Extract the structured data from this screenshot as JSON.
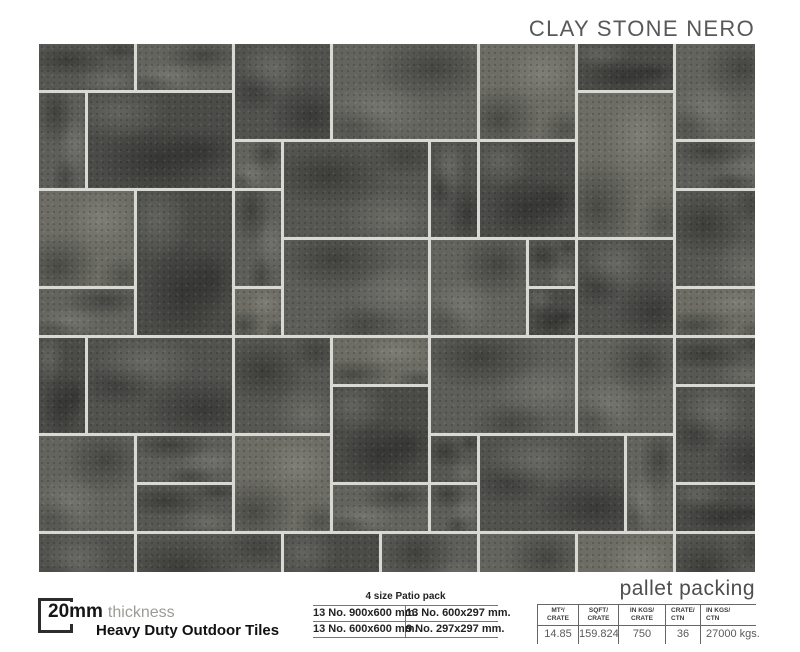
{
  "header": {
    "title": "CLAY STONE NERO"
  },
  "product": {
    "thickness_value": "20mm",
    "thickness_label": "thickness",
    "subtitle": "Heavy Duty Outdoor Tiles"
  },
  "patio_pack": {
    "title": "4 size Patio pack",
    "rows": [
      [
        "13 No. 900x600 mm.",
        "13 No. 600x297 mm."
      ],
      [
        "13 No. 600x600 mm.",
        "9 No. 297x297 mm."
      ]
    ]
  },
  "pallet_packing": {
    "title": "pallet packing",
    "columns": [
      {
        "header": "MT²/\nCRATE",
        "value": "14.85"
      },
      {
        "header": "SQFT/\nCRATE",
        "value": "159.824"
      },
      {
        "header": "IN KGS/\nCRATE",
        "value": "750"
      },
      {
        "header": "CRATE/\nCTN",
        "value": "36"
      },
      {
        "header": "IN KGS/\nCTN",
        "value": "27000 kgs."
      }
    ]
  },
  "pattern": {
    "unit": 49,
    "grout_px": 3,
    "grout_color": "#d9d9d4",
    "variants": [
      "#575753",
      "#64645f",
      "#4b4b48",
      "#6d6d66",
      "#52524f",
      "#5e5e5a"
    ],
    "tiles": [
      [
        0,
        0,
        2,
        1,
        0
      ],
      [
        2,
        0,
        2,
        1,
        1
      ],
      [
        4,
        0,
        2,
        2,
        4
      ],
      [
        6,
        0,
        3,
        2,
        1
      ],
      [
        9,
        0,
        2,
        2,
        3
      ],
      [
        11,
        0,
        2,
        1,
        2
      ],
      [
        13,
        0,
        2,
        2,
        1
      ],
      [
        0,
        1,
        1,
        2,
        5
      ],
      [
        1,
        1,
        3,
        2,
        2
      ],
      [
        11,
        1,
        2,
        3,
        3
      ],
      [
        4,
        2,
        1,
        1,
        1
      ],
      [
        5,
        2,
        3,
        2,
        0
      ],
      [
        8,
        2,
        1,
        2,
        4
      ],
      [
        9,
        2,
        2,
        2,
        2
      ],
      [
        13,
        2,
        2,
        1,
        5
      ],
      [
        0,
        3,
        2,
        2,
        3
      ],
      [
        2,
        3,
        2,
        3,
        2
      ],
      [
        4,
        3,
        1,
        2,
        5
      ],
      [
        13,
        3,
        2,
        2,
        0
      ],
      [
        5,
        4,
        3,
        2,
        5
      ],
      [
        8,
        4,
        2,
        2,
        1
      ],
      [
        10,
        4,
        1,
        1,
        0
      ],
      [
        11,
        4,
        2,
        2,
        4
      ],
      [
        0,
        5,
        2,
        1,
        1
      ],
      [
        4,
        5,
        1,
        1,
        3
      ],
      [
        10,
        5,
        1,
        1,
        2
      ],
      [
        13,
        5,
        2,
        1,
        3
      ],
      [
        0,
        6,
        1,
        2,
        2
      ],
      [
        1,
        6,
        3,
        2,
        4
      ],
      [
        4,
        6,
        2,
        2,
        0
      ],
      [
        6,
        6,
        2,
        1,
        3
      ],
      [
        8,
        6,
        3,
        2,
        5
      ],
      [
        11,
        6,
        2,
        2,
        1
      ],
      [
        13,
        6,
        2,
        1,
        0
      ],
      [
        6,
        7,
        2,
        2,
        2
      ],
      [
        13,
        7,
        2,
        2,
        4
      ],
      [
        0,
        8,
        2,
        2,
        1
      ],
      [
        2,
        8,
        2,
        1,
        5
      ],
      [
        4,
        8,
        2,
        2,
        3
      ],
      [
        8,
        8,
        1,
        1,
        0
      ],
      [
        9,
        8,
        3,
        2,
        4
      ],
      [
        12,
        8,
        1,
        2,
        1
      ],
      [
        2,
        9,
        2,
        1,
        0
      ],
      [
        6,
        9,
        2,
        1,
        1
      ],
      [
        8,
        9,
        1,
        1,
        5
      ],
      [
        13,
        9,
        2,
        1,
        2
      ],
      [
        0,
        10,
        2,
        2,
        4
      ],
      [
        2,
        10,
        3,
        2,
        0
      ],
      [
        5,
        10,
        2,
        2,
        2
      ],
      [
        7,
        10,
        2,
        2,
        5
      ],
      [
        9,
        10,
        2,
        2,
        1
      ],
      [
        11,
        10,
        2,
        2,
        3
      ],
      [
        13,
        10,
        2,
        2,
        0
      ]
    ]
  }
}
